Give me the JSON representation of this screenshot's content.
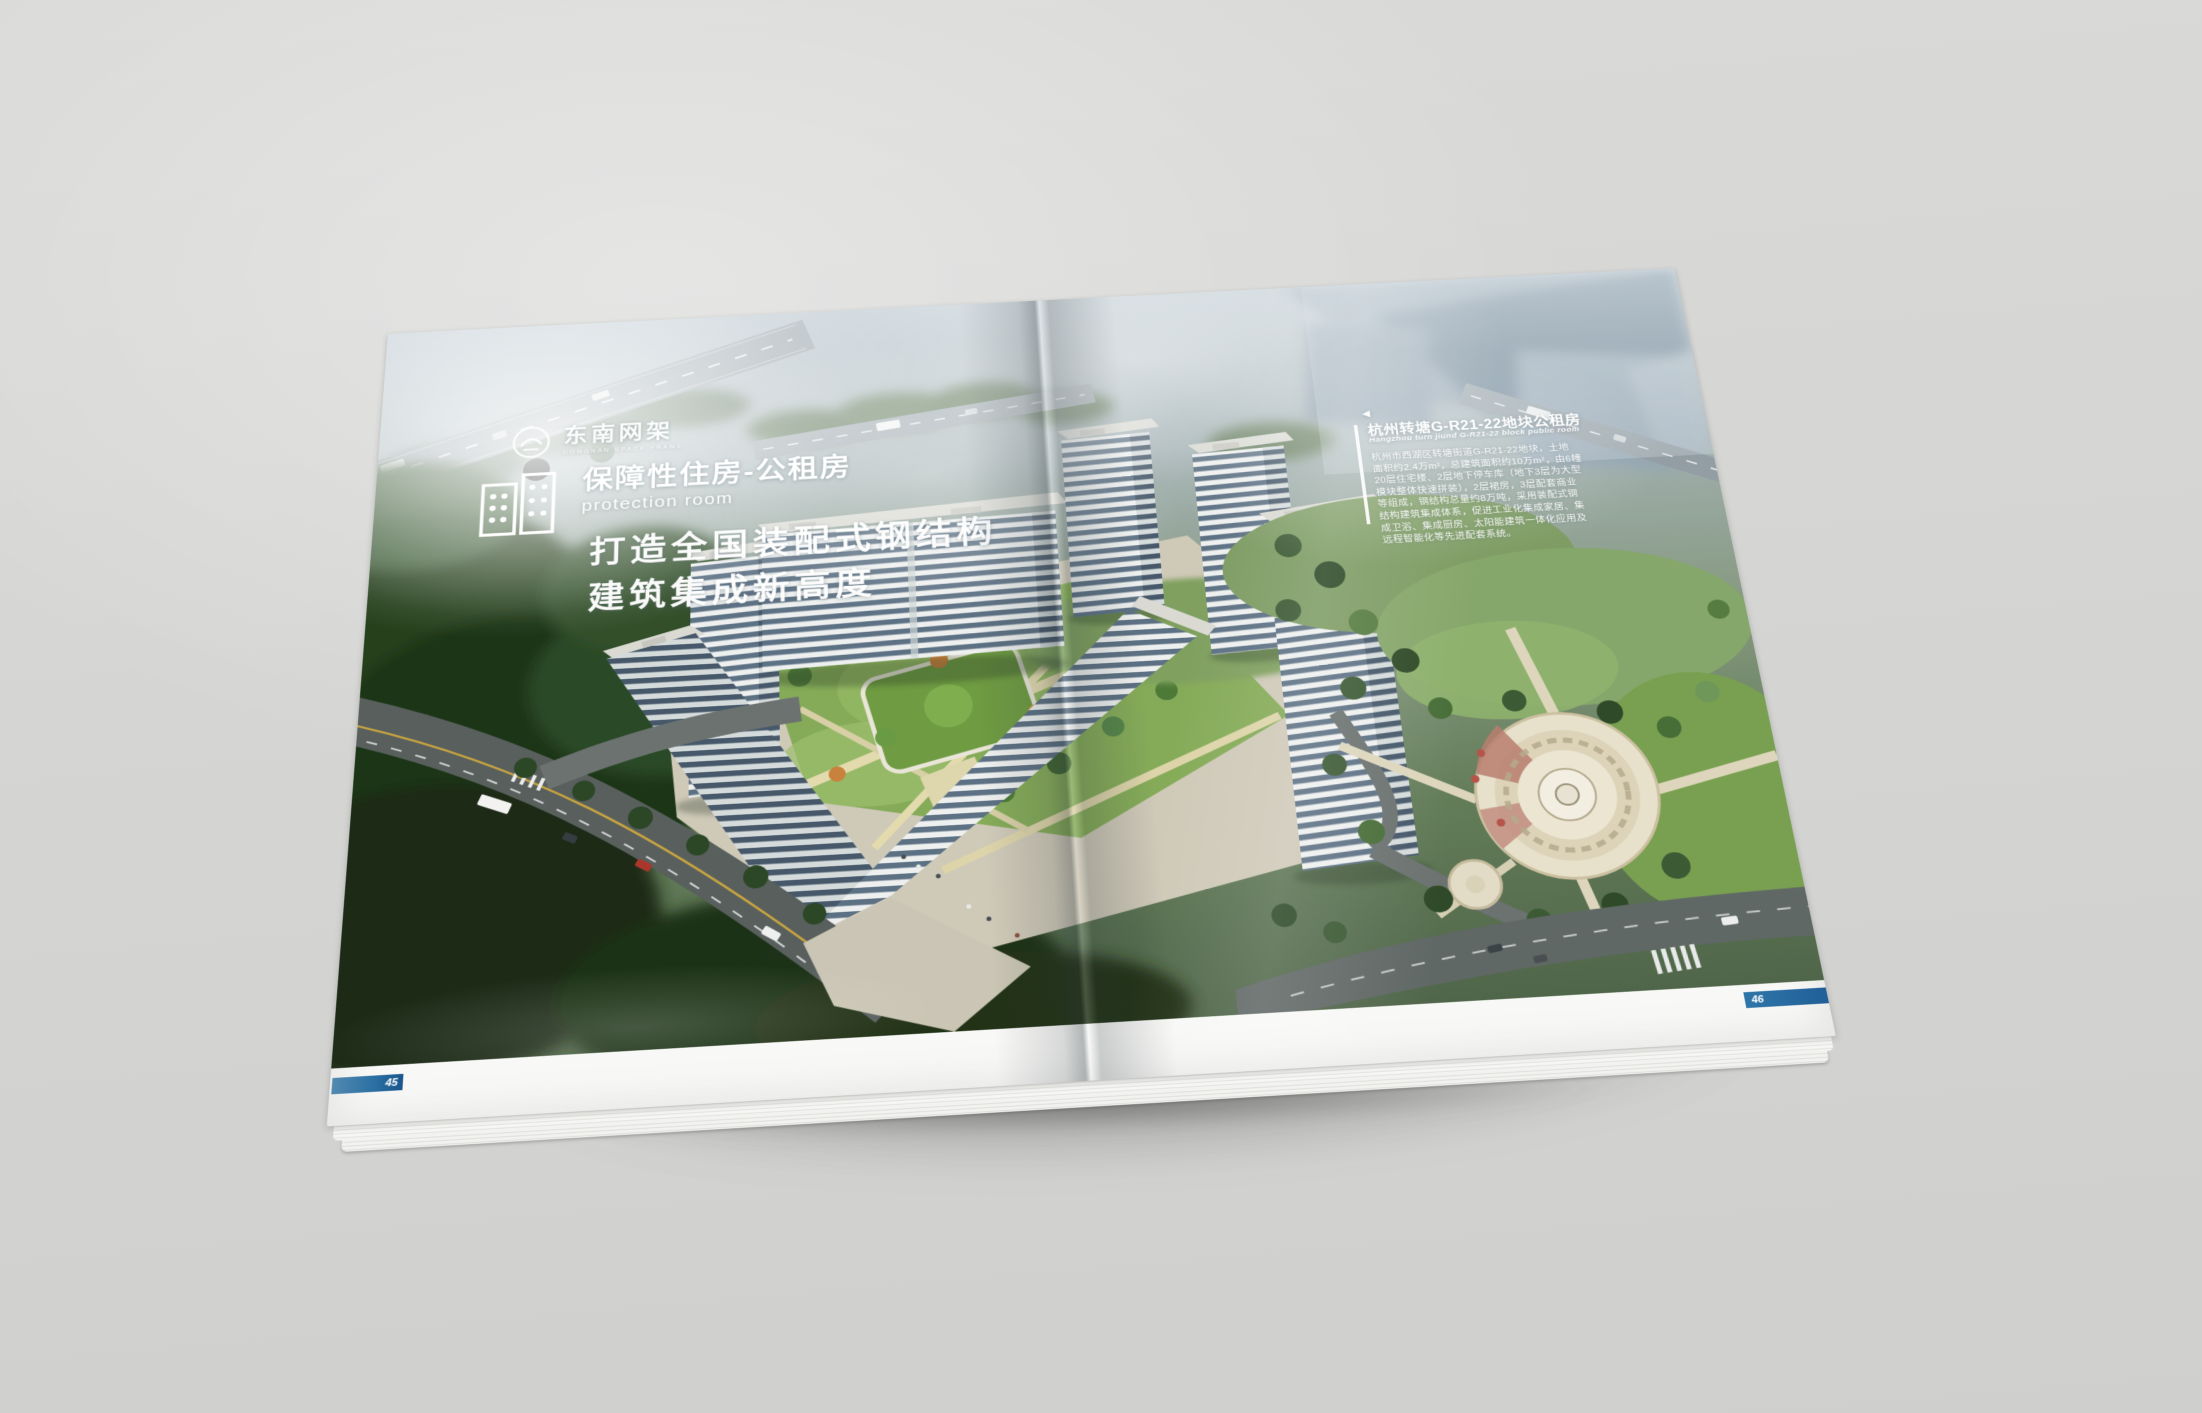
{
  "logo": {
    "name": "东南网架",
    "tagline": "DONGNAN SPACE FRAME"
  },
  "left_page": {
    "program": {
      "title": "保障性住房-公租房",
      "subtitle": "protection room"
    },
    "headline": {
      "line1": "打造全国装配式钢结构",
      "line2": "建筑集成新高度"
    },
    "page_number": "45"
  },
  "right_page": {
    "info_box": {
      "marker": "◀",
      "title": "杭州转塘G-R21-22地块公租房",
      "subtitle": "Hangzhou turn jiund G-R21-22 block public room",
      "body_lines": [
        "杭州市西湖区转塘街道G-R21-22地块，土地",
        "面积约2.4万m²，总建筑面积约10万m²，由6幢",
        "20层住宅楼、2层地下停车库（地下3层为大型",
        "模块整体快速拼装），2层裙房，3层配套商业",
        "等组成，钢结构总量约8万吨，采用装配式钢",
        "结构建筑集成体系，促进工业化集成家居、集",
        "成卫浴、集成厨房、太阳能建筑一体化应用及",
        "远程智能化等先进配套系统。"
      ]
    },
    "page_number": "46"
  },
  "colors": {
    "backdrop_gray": "#d6d6d4",
    "accent_blue": "#2e72a4",
    "page_bar_dark_blue": "#1a568c",
    "text_white": "#ffffff"
  }
}
